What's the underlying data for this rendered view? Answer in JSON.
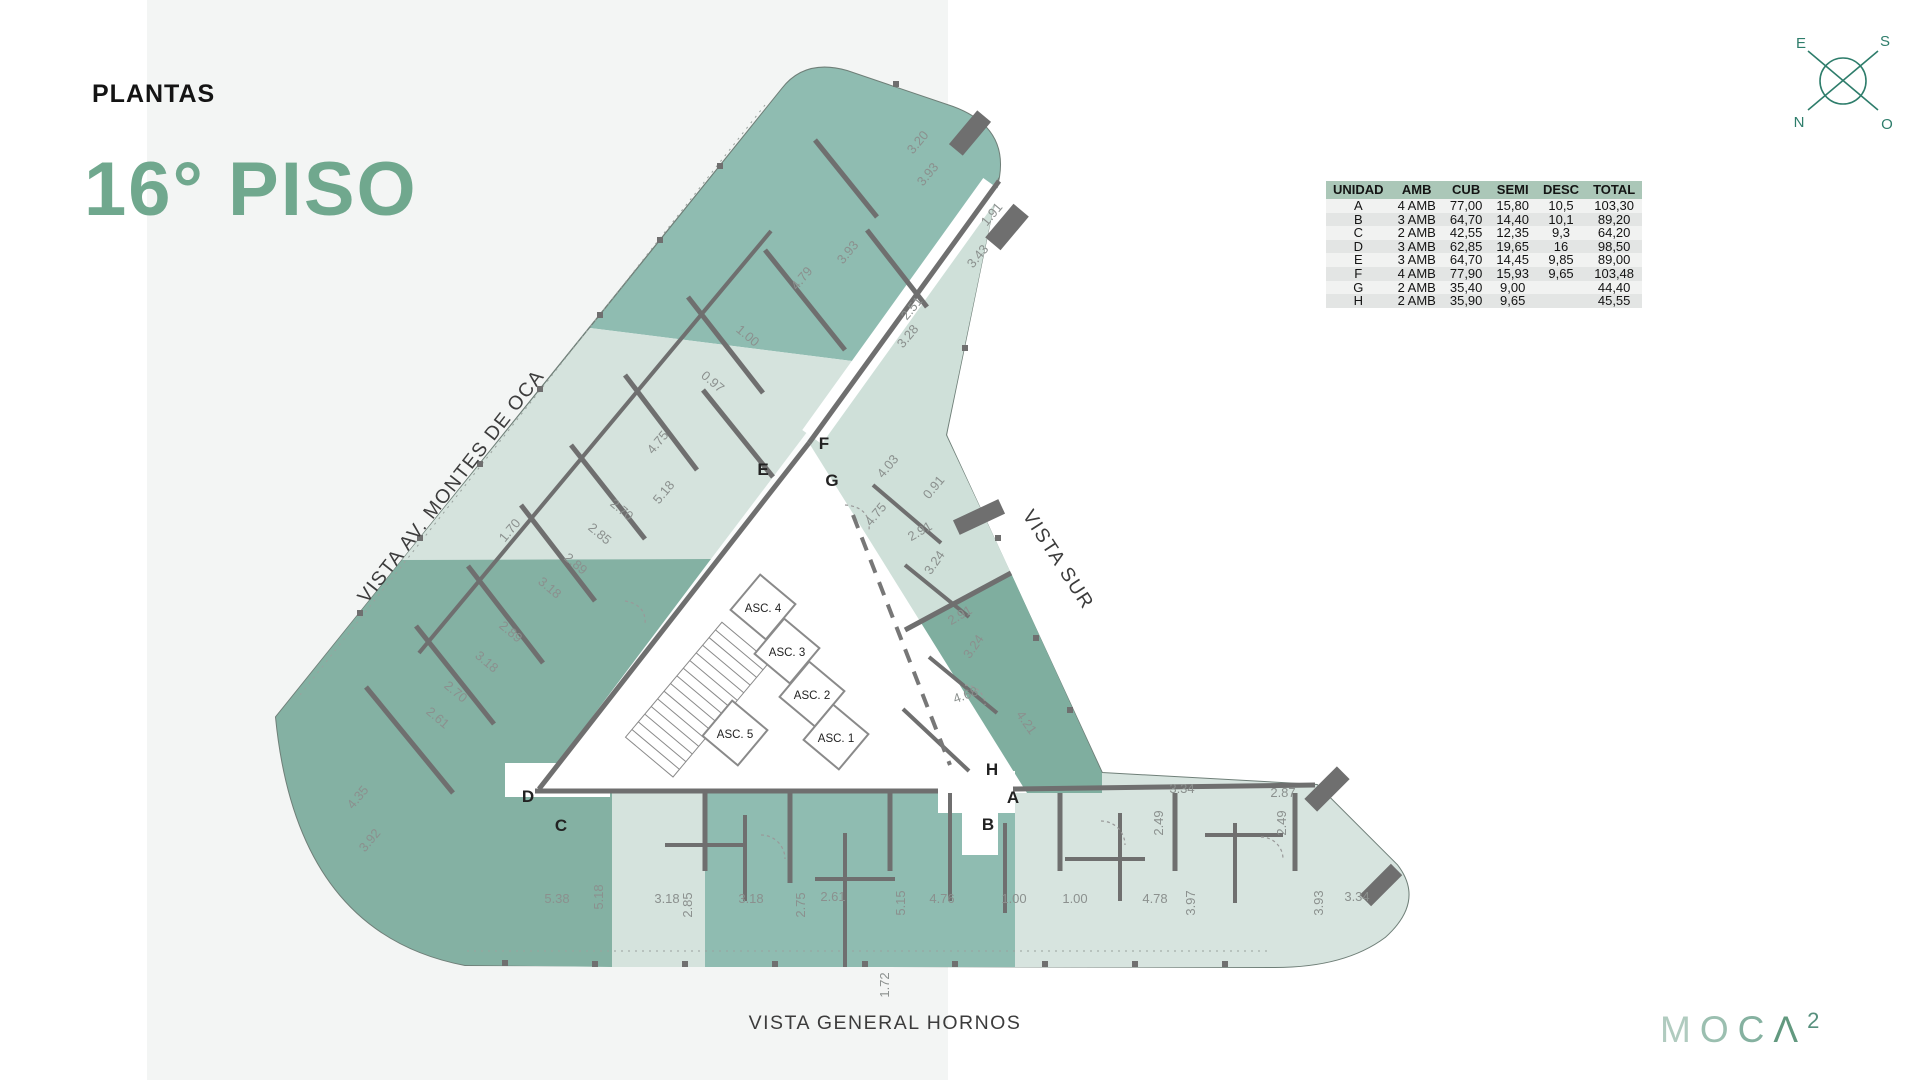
{
  "page": {
    "title_label": "PLANTAS",
    "floor_title": "16° PISO"
  },
  "compass": {
    "top_left": "E",
    "top_right": "S",
    "bottom_left": "N",
    "bottom_right": "O"
  },
  "table": {
    "headers": [
      "UNIDAD",
      "AMB",
      "CUB",
      "SEMI",
      "DESC",
      "TOTAL"
    ],
    "rows": [
      [
        "A",
        "4 AMB",
        "77,00",
        "15,80",
        "10,5",
        "103,30"
      ],
      [
        "B",
        "3 AMB",
        "64,70",
        "14,40",
        "10,1",
        "89,20"
      ],
      [
        "C",
        "2 AMB",
        "42,55",
        "12,35",
        "9,3",
        "64,20"
      ],
      [
        "D",
        "3 AMB",
        "62,85",
        "19,65",
        "16",
        "98,50"
      ],
      [
        "E",
        "3 AMB",
        "64,70",
        "14,45",
        "9,85",
        "89,00"
      ],
      [
        "F",
        "4 AMB",
        "77,90",
        "15,93",
        "9,65",
        "103,48"
      ],
      [
        "G",
        "2 AMB",
        "35,40",
        "9,00",
        "",
        "44,40"
      ],
      [
        "H",
        "2 AMB",
        "35,90",
        "9,65",
        "",
        "45,55"
      ]
    ]
  },
  "plan": {
    "vista_labels": [
      {
        "text": "VISTA AV. MONTES DE OCA",
        "x": 251,
        "y": 445,
        "rot": -52
      },
      {
        "text": "VISTA SUR",
        "x": 848,
        "y": 518,
        "rot": 57
      },
      {
        "text": "VISTA GENERAL HORNOS",
        "x": 680,
        "y": 984,
        "rot": 0
      }
    ],
    "unit_labels": [
      {
        "t": "F",
        "x": 619,
        "y": 404
      },
      {
        "t": "E",
        "x": 558,
        "y": 430
      },
      {
        "t": "G",
        "x": 627,
        "y": 441
      },
      {
        "t": "D",
        "x": 323,
        "y": 757
      },
      {
        "t": "C",
        "x": 356,
        "y": 786
      },
      {
        "t": "H",
        "x": 787,
        "y": 730
      },
      {
        "t": "A",
        "x": 808,
        "y": 758
      },
      {
        "t": "B",
        "x": 783,
        "y": 785
      }
    ],
    "elevators": [
      {
        "t": "ASC. 4",
        "x": 558,
        "y": 567
      },
      {
        "t": "ASC. 3",
        "x": 582,
        "y": 611
      },
      {
        "t": "ASC. 2",
        "x": 607,
        "y": 654
      },
      {
        "t": "ASC. 1",
        "x": 631,
        "y": 697
      },
      {
        "t": "ASC. 5",
        "x": 530,
        "y": 693
      }
    ],
    "dimensions": [
      {
        "t": "3.20",
        "x": 716,
        "y": 100,
        "r": -50
      },
      {
        "t": "3.93",
        "x": 726,
        "y": 132,
        "r": -50
      },
      {
        "t": "1.91",
        "x": 790,
        "y": 172,
        "r": -50
      },
      {
        "t": "3.43",
        "x": 776,
        "y": 214,
        "r": -50
      },
      {
        "t": "3.93",
        "x": 646,
        "y": 210,
        "r": -50
      },
      {
        "t": "4.79",
        "x": 600,
        "y": 236,
        "r": -50
      },
      {
        "t": "2.51",
        "x": 710,
        "y": 266,
        "r": -50
      },
      {
        "t": "3.28",
        "x": 706,
        "y": 294,
        "r": -50
      },
      {
        "t": "1.00",
        "x": 540,
        "y": 294,
        "r": 40
      },
      {
        "t": "0.97",
        "x": 505,
        "y": 340,
        "r": 40
      },
      {
        "t": "4.75",
        "x": 456,
        "y": 400,
        "r": -50
      },
      {
        "t": "5.18",
        "x": 462,
        "y": 450,
        "r": -50
      },
      {
        "t": "2.70",
        "x": 414,
        "y": 468,
        "r": 40
      },
      {
        "t": "2.85",
        "x": 392,
        "y": 492,
        "r": 40
      },
      {
        "t": "1.70",
        "x": 308,
        "y": 488,
        "r": -50
      },
      {
        "t": "2.89",
        "x": 368,
        "y": 522,
        "r": 40
      },
      {
        "t": "3.18",
        "x": 342,
        "y": 546,
        "r": 40
      },
      {
        "t": "2.89",
        "x": 303,
        "y": 590,
        "r": 40
      },
      {
        "t": "3.18",
        "x": 279,
        "y": 620,
        "r": 40
      },
      {
        "t": "2.70",
        "x": 248,
        "y": 650,
        "r": 40
      },
      {
        "t": "2.61",
        "x": 230,
        "y": 676,
        "r": 40
      },
      {
        "t": "4.35",
        "x": 156,
        "y": 755,
        "r": -50
      },
      {
        "t": "3.92",
        "x": 168,
        "y": 798,
        "r": -50
      },
      {
        "t": "4.03",
        "x": 686,
        "y": 424,
        "r": -50
      },
      {
        "t": "0.91",
        "x": 732,
        "y": 445,
        "r": -50
      },
      {
        "t": "4.75",
        "x": 674,
        "y": 472,
        "r": -50
      },
      {
        "t": "2.91",
        "x": 717,
        "y": 490,
        "r": -30
      },
      {
        "t": "3.24",
        "x": 733,
        "y": 520,
        "r": -55
      },
      {
        "t": "2.91",
        "x": 757,
        "y": 574,
        "r": -30
      },
      {
        "t": "3.24",
        "x": 772,
        "y": 604,
        "r": -55
      },
      {
        "t": "4.68",
        "x": 762,
        "y": 654,
        "r": -20
      },
      {
        "t": "4.21",
        "x": 818,
        "y": 680,
        "r": 55
      },
      {
        "t": "3.34",
        "x": 977,
        "y": 748,
        "r": 0
      },
      {
        "t": "2.87",
        "x": 1078,
        "y": 752,
        "r": 0
      },
      {
        "t": "2.49",
        "x": 958,
        "y": 778,
        "r": -90
      },
      {
        "t": "2.49",
        "x": 1081,
        "y": 778,
        "r": -90
      },
      {
        "t": "5.38",
        "x": 352,
        "y": 858,
        "r": 0
      },
      {
        "t": "5.18",
        "x": 398,
        "y": 852,
        "r": -90
      },
      {
        "t": "3.18",
        "x": 462,
        "y": 858,
        "r": 0
      },
      {
        "t": "2.85",
        "x": 487,
        "y": 860,
        "r": -90
      },
      {
        "t": "3.18",
        "x": 546,
        "y": 858,
        "r": 0
      },
      {
        "t": "2.75",
        "x": 600,
        "y": 860,
        "r": -90
      },
      {
        "t": "2.61",
        "x": 628,
        "y": 856,
        "r": 0
      },
      {
        "t": "5.15",
        "x": 700,
        "y": 858,
        "r": -90
      },
      {
        "t": "4.76",
        "x": 737,
        "y": 858,
        "r": 0
      },
      {
        "t": "1.00",
        "x": 809,
        "y": 858,
        "r": 0
      },
      {
        "t": "1.00",
        "x": 870,
        "y": 858,
        "r": 0
      },
      {
        "t": "4.78",
        "x": 950,
        "y": 858,
        "r": 0
      },
      {
        "t": "3.97",
        "x": 990,
        "y": 858,
        "r": -90
      },
      {
        "t": "3.93",
        "x": 1118,
        "y": 858,
        "r": -90
      },
      {
        "t": "3.34",
        "x": 1152,
        "y": 856,
        "r": 0
      },
      {
        "t": "1.72",
        "x": 684,
        "y": 940,
        "r": -90
      }
    ]
  },
  "logo": {
    "letters": [
      {
        "ch": "M",
        "color": "#b0cbbf"
      },
      {
        "ch": "O",
        "color": "#9bbfb0"
      },
      {
        "ch": "C",
        "color": "#85b1a0"
      },
      {
        "ch": "Λ",
        "color": "#62997f"
      }
    ],
    "sup": {
      "ch": "2",
      "color": "#57907d"
    }
  },
  "colors": {
    "accent_green": "#70a88e",
    "table_header": "#abc7b8",
    "unit_dark": "#84b1a3",
    "unit_medium": "#8fbcb1",
    "unit_light": "#d5e3dd",
    "wall_gray": "#6f6f6f",
    "compass": "#2e7d6b",
    "band": "#f3f5f4"
  }
}
